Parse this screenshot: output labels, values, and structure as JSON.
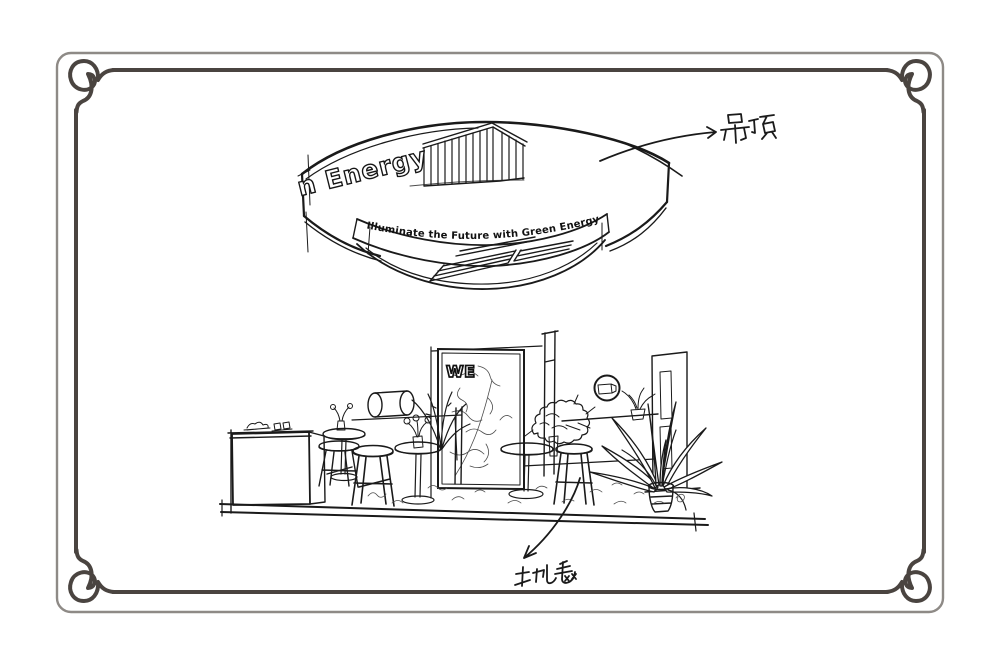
{
  "page": {
    "background": "#ffffff"
  },
  "frame": {
    "outer_color": "#8e8a86",
    "inner_color": "#4a4440"
  },
  "ink": {
    "primary": "#1a1a1a",
    "light": "#4d4d4d"
  },
  "ceiling": {
    "brand_text": "n Energy",
    "slogan": "Illuminate the Future with Green Energy"
  },
  "booth": {
    "panel_logo": "WE"
  },
  "annotations": {
    "ceiling": {
      "label": "吊顶"
    },
    "carpet": {
      "label": "地毯"
    }
  }
}
